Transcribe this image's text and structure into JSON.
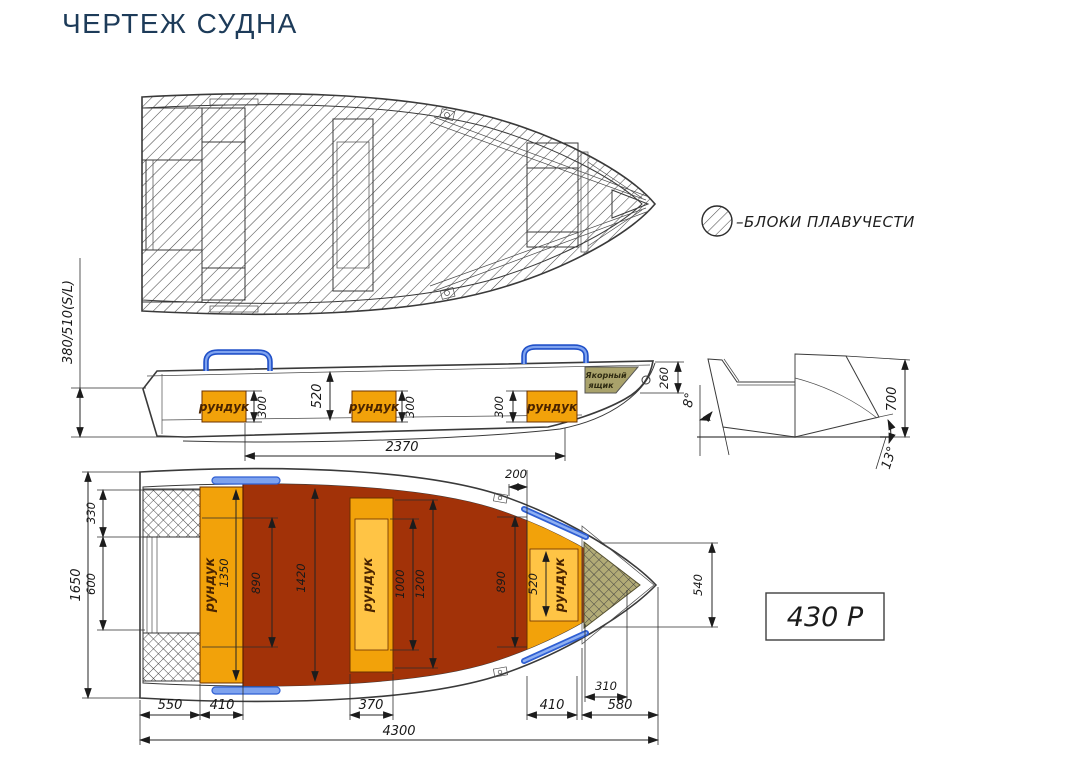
{
  "page": {
    "title": "ЧЕРТЕЖ СУДНА"
  },
  "legend": {
    "label": "–БЛОКИ ПЛАВУЧЕСТИ"
  },
  "price": {
    "label": "430 Р"
  },
  "colors": {
    "title_navy": "#1d3b59",
    "hull_gray": "#d7d7d7",
    "floor_red": "#a23208",
    "bench_orange": "#f2a20a",
    "bench_orange_light": "#ffc445",
    "handle_blue": "#5d87e8",
    "anchor_olive": "#a9a26b"
  },
  "side_view": {
    "lockers": [
      "рундук",
      "рундук",
      "рундук"
    ],
    "anchor_box": {
      "line1": "Якорный",
      "line2": "ящик"
    },
    "dims": {
      "stern_height": "380/510(S/L)",
      "locker1_depth": "300",
      "cockpit_depth": "520",
      "locker2_depth": "300",
      "locker3_depth": "300",
      "cockpit_length": "2370",
      "bow_height": "260"
    }
  },
  "transom_view": {
    "dims": {
      "transom_angle": "8°",
      "side_height": "700",
      "deadrise_angle": "13°"
    }
  },
  "deck_view": {
    "lockers": [
      "рундук",
      "рундук",
      "рундук"
    ],
    "dims": {
      "oarlock_offset": "200",
      "block_width": "330",
      "transom_width": "600",
      "beam": "1650",
      "locker1_length": "1350",
      "floor_width_aft": "890",
      "floor_length": "1420",
      "locker2_inner": "1000",
      "locker2_outer": "1200",
      "floor_width_fwd": "890",
      "locker3_inner": "520",
      "bow_width": "540",
      "bow_block": "310",
      "d550": "550",
      "d410_aft": "410",
      "d370": "370",
      "d410_fwd": "410",
      "d580": "580",
      "overall_length": "4300"
    }
  }
}
